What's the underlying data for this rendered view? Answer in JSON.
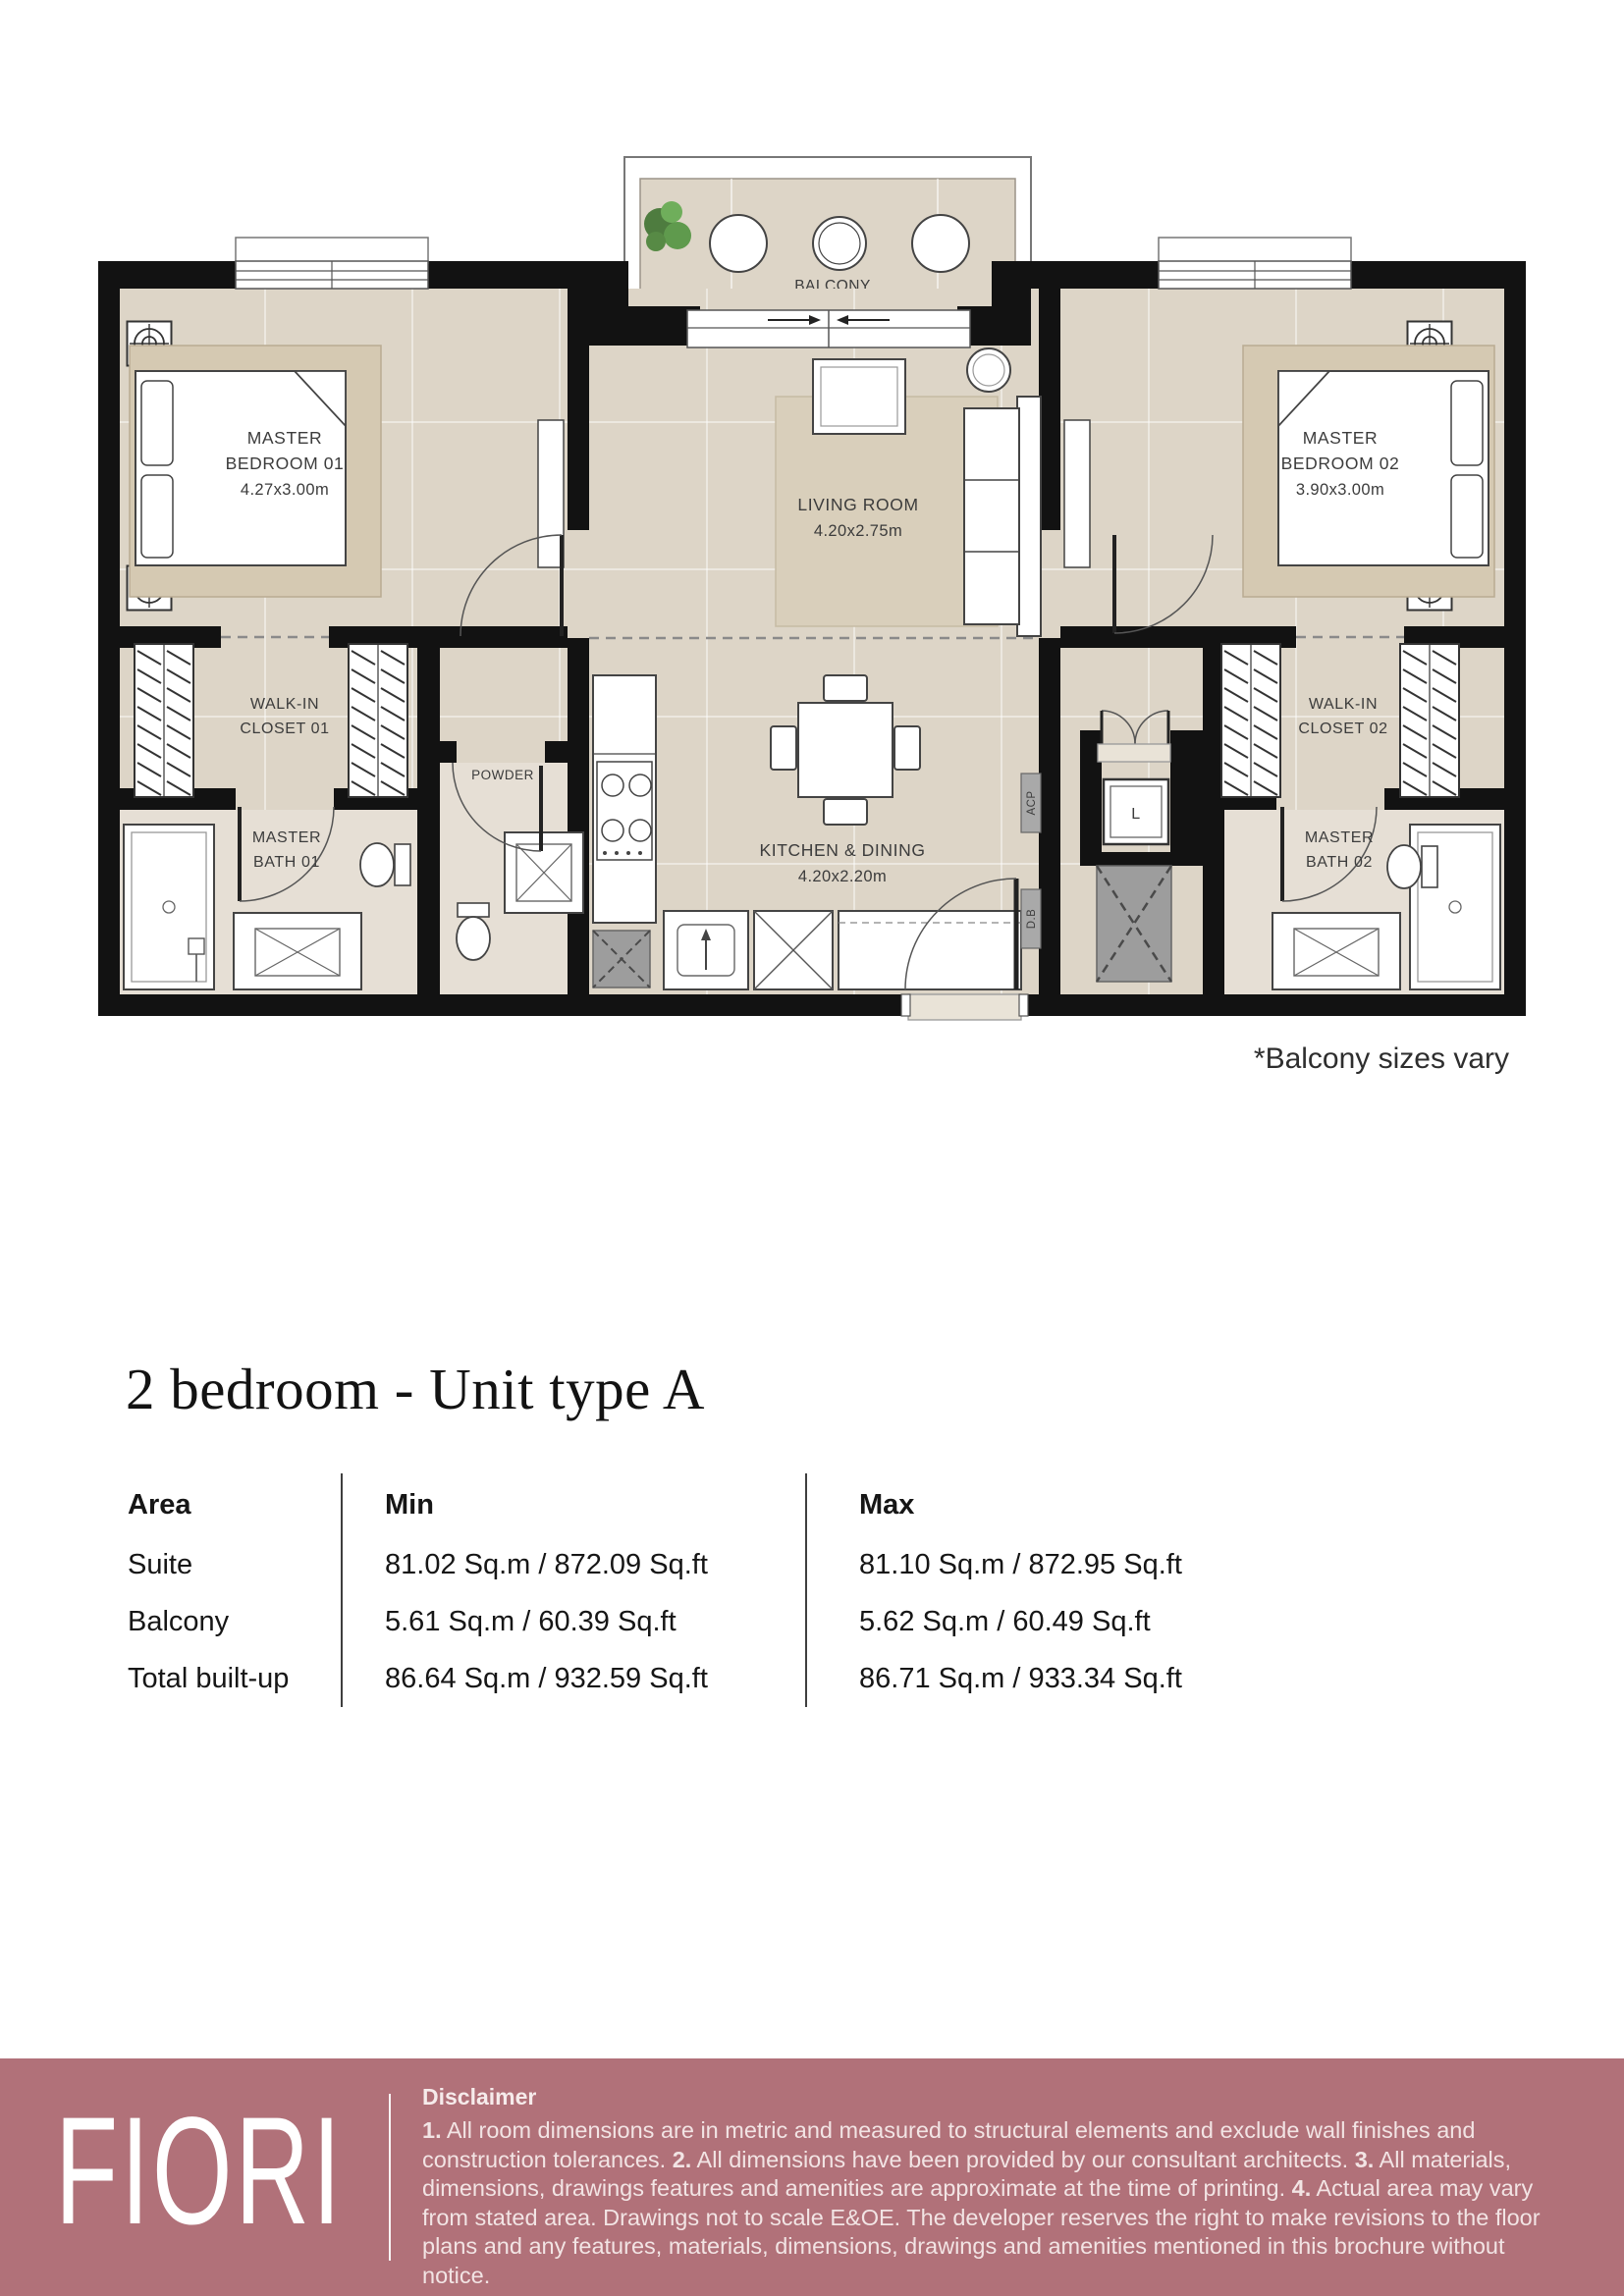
{
  "note": "*Balcony sizes vary",
  "title": "2 bedroom - Unit type A",
  "floorplan": {
    "balcony": "BALCONY",
    "bedroom1": {
      "l1": "MASTER",
      "l2": "BEDROOM 01",
      "l3": "4.27x3.00m"
    },
    "bedroom2": {
      "l1": "MASTER",
      "l2": "BEDROOM 02",
      "l3": "3.90x3.00m"
    },
    "living": {
      "l1": "LIVING ROOM",
      "l2": "4.20x2.75m"
    },
    "kitchen": {
      "l1": "KITCHEN & DINING",
      "l2": "4.20x2.20m"
    },
    "closet1": {
      "l1": "WALK-IN",
      "l2": "CLOSET 01"
    },
    "closet2": {
      "l1": "WALK-IN",
      "l2": "CLOSET 02"
    },
    "bath1": {
      "l1": "MASTER",
      "l2": "BATH 01"
    },
    "bath2": {
      "l1": "MASTER",
      "l2": "BATH 02"
    },
    "powder": "POWDER",
    "lift": "L",
    "acp": "ACP",
    "db": "D.B"
  },
  "table": {
    "headers": {
      "area": "Area",
      "min": "Min",
      "max": "Max"
    },
    "rows": [
      {
        "area": "Suite",
        "min": "81.02 Sq.m / 872.09 Sq.ft",
        "max": "81.10 Sq.m / 872.95 Sq.ft"
      },
      {
        "area": "Balcony",
        "min": "5.61 Sq.m / 60.39 Sq.ft",
        "max": "5.62 Sq.m / 60.49 Sq.ft"
      },
      {
        "area": "Total built-up",
        "min": "86.64 Sq.m / 932.59 Sq.ft",
        "max": "86.71 Sq.m / 933.34 Sq.ft"
      }
    ]
  },
  "footer": {
    "brand": "FIORI",
    "disclaimer_title": "Disclaimer",
    "d1n": "1.",
    "d1": " All room dimensions are in metric and measured to structural elements and exclude wall finishes and construction tolerances. ",
    "d2n": "2.",
    "d2": " All dimensions have been provided by our consultant architects. ",
    "d3n": "3.",
    "d3": " All materials, dimensions, drawings features and amenities are approximate at the time of printing. ",
    "d4n": "4.",
    "d4": " Actual area may vary from stated area. Drawings not to scale E&OE. The developer reserves the right to make revisions to the floor plans and any features, materials, dimensions, drawings and amenities mentioned in this brochure without notice."
  },
  "colors": {
    "footer_bg": "#b17179",
    "footer_text": "#f2e4e4",
    "wall": "#121212",
    "floor": "#ddd5c7",
    "bath_floor": "#e6dfd5",
    "bed_platform": "#d5c9b2",
    "rug": "#d9cfbb",
    "shaft_gray": "#9d9d9d",
    "plant_green": "#5f9a4d"
  }
}
